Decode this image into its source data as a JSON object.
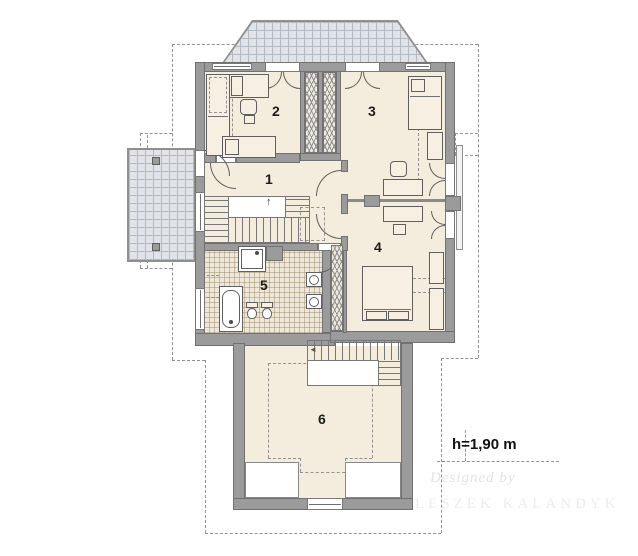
{
  "plan": {
    "rooms": [
      {
        "label": "1"
      },
      {
        "label": "2"
      },
      {
        "label": "3"
      },
      {
        "label": "4"
      },
      {
        "label": "5"
      },
      {
        "label": "6"
      }
    ],
    "annotation": {
      "height_note": "h=1,90 m"
    },
    "watermark": {
      "line1": "Designed by",
      "line2": "LESZEK KALANDYK"
    },
    "symbols": {
      "stairs_up_arrow": "↑",
      "stairs_down_marker": "◄"
    },
    "colors": {
      "wall": "#9b9b9b",
      "floor": "#f4ecdc",
      "terrace_tile": "#e0e3e7",
      "bath_tile": "#efe8d9",
      "furniture_line": "#5f5f5f",
      "roof_dash": "#929292",
      "text": "#1c1c1c",
      "watermark": "#e3e3e3"
    }
  }
}
